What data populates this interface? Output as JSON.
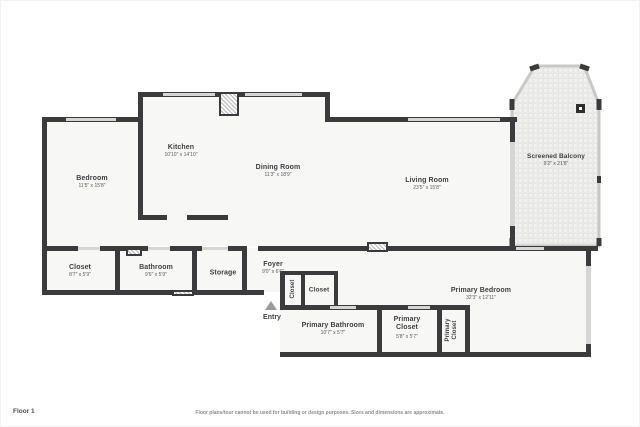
{
  "page": {
    "entry": {
      "label": "Entry"
    },
    "footer": {
      "floor_label": "Floor 1",
      "disclaimer": "Floor plans/tour cannot be used for building or design purposes. Sizes and dimensions are approximate."
    }
  },
  "rooms": {
    "bedroom": {
      "name": "Bedroom",
      "dims": "11'5\" x 15'8\""
    },
    "kitchen": {
      "name": "Kitchen",
      "dims": "10'10\" x 14'10\""
    },
    "dining_room": {
      "name": "Dining Room",
      "dims": "11'3\" x 18'9\""
    },
    "living_room": {
      "name": "Living Room",
      "dims": "23'5\" x 15'8\""
    },
    "screened_balcony": {
      "name": "Screened Balcony",
      "dims": "9'2\" x 21'8\""
    },
    "closet": {
      "name": "Closet",
      "dims": "8'7\" x 5'9\""
    },
    "bathroom": {
      "name": "Bathroom",
      "dims": "9'6\" x 5'9\""
    },
    "storage": {
      "name": "Storage"
    },
    "foyer": {
      "name": "Foyer",
      "dims": "9'0\" x 6'6\""
    },
    "hall_closet_vertical": {
      "name": "Closet"
    },
    "hall_closet": {
      "name": "Closet"
    },
    "primary_bathroom": {
      "name": "Primary Bathroom",
      "dims": "10'7\" x 5'7\""
    },
    "primary_closet": {
      "name": "Primary Closet",
      "dims": "5'8\" x 5'7\""
    },
    "primary_closet_vertical": {
      "name": "Primary Closet"
    },
    "primary_bedroom": {
      "name": "Primary Bedroom",
      "dims": "32'3\" x 12'11\""
    }
  },
  "colors": {
    "wall": "#3b3b3d",
    "floor": "#f7f7f6",
    "window": "#d6d6d6",
    "label": "#3f4043"
  }
}
